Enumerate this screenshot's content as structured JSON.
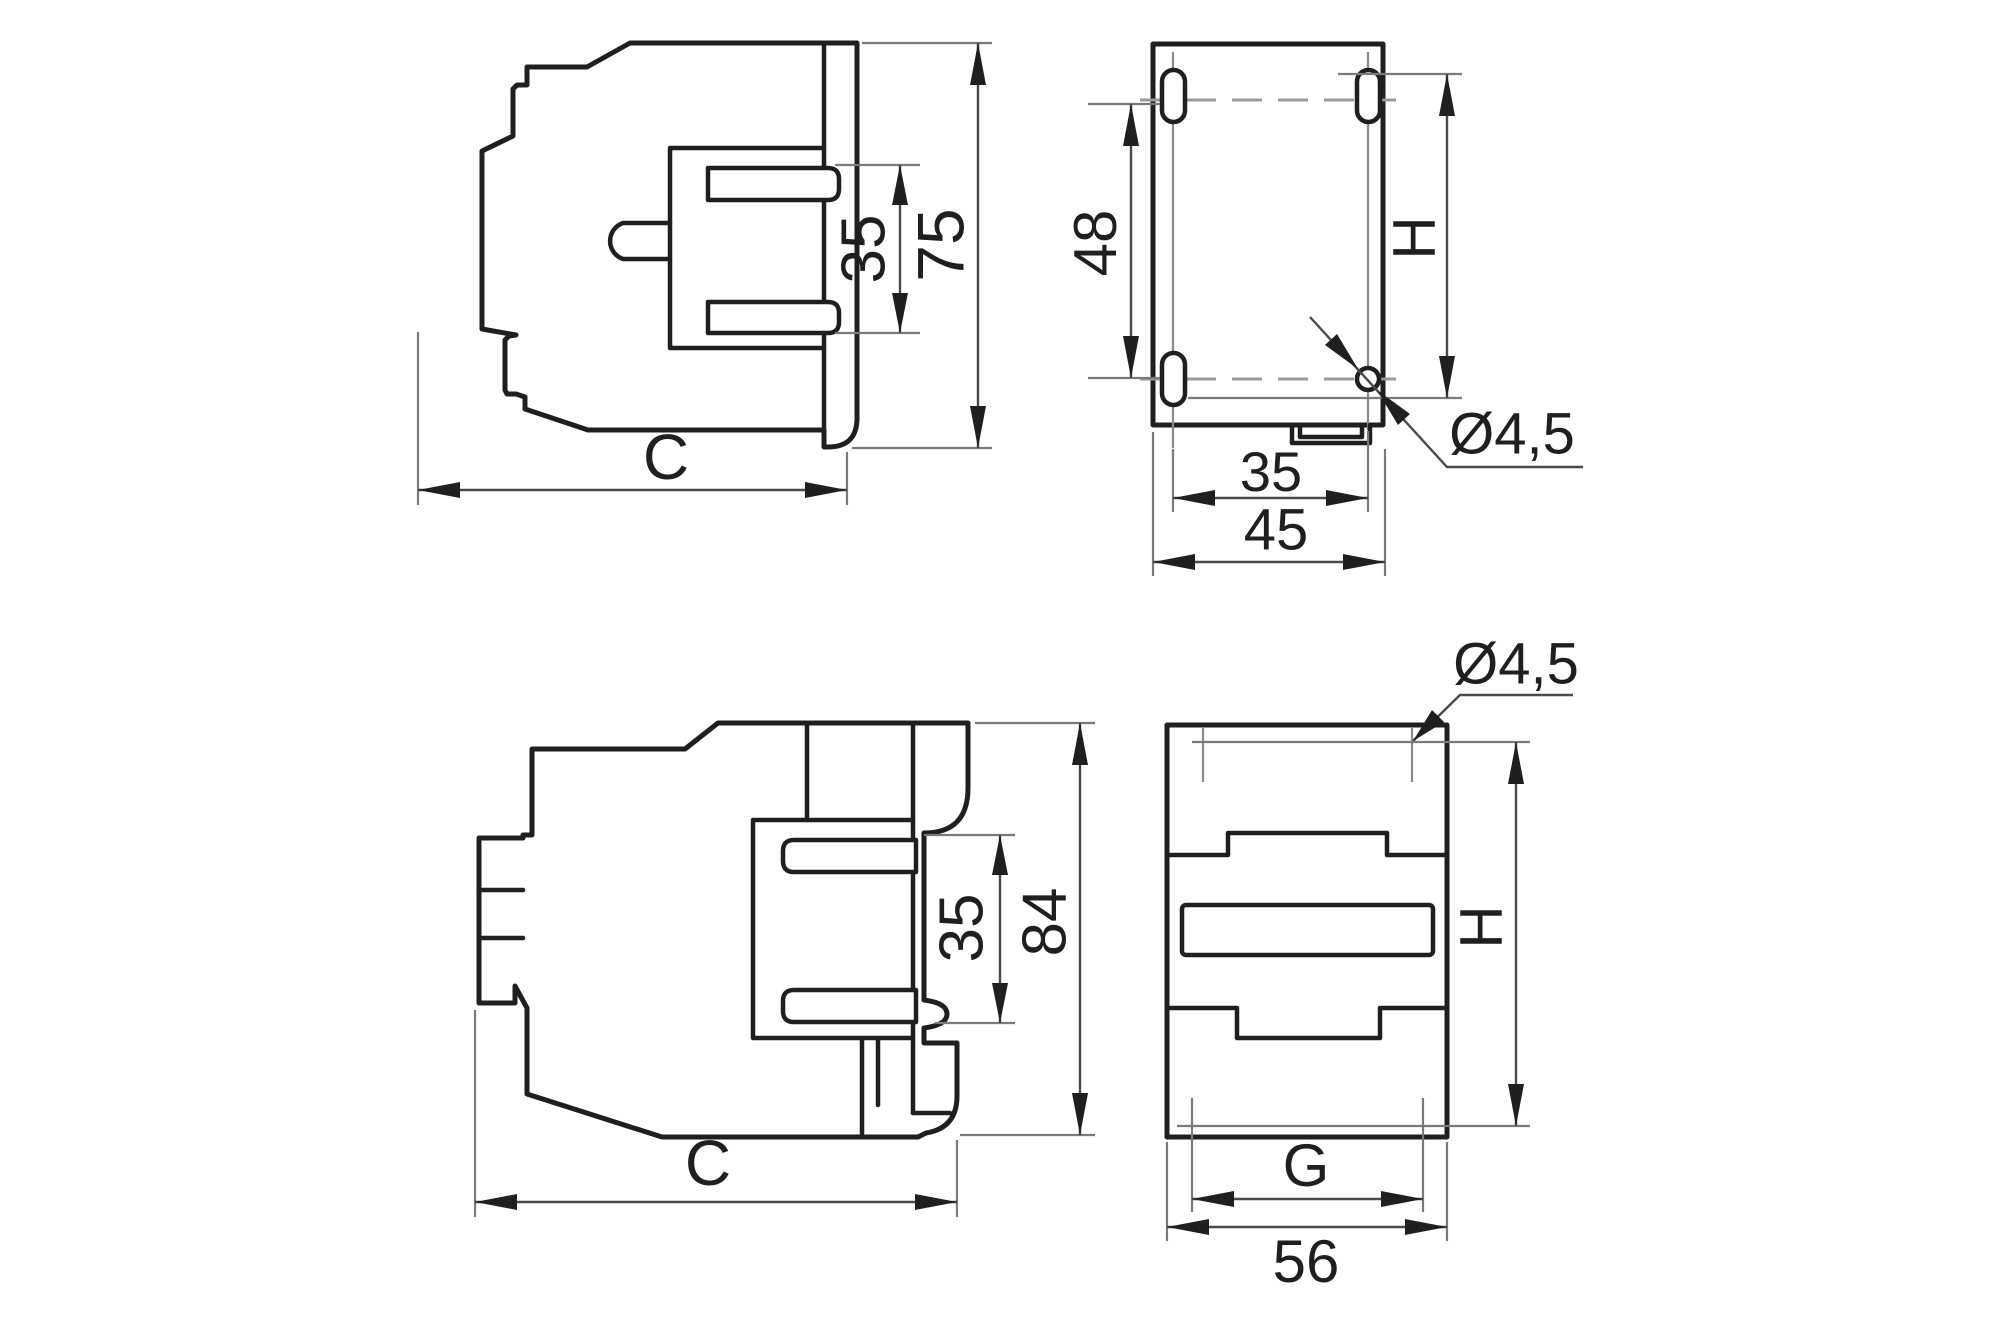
{
  "colors": {
    "background": "#ffffff",
    "outline": "#1f1f1f",
    "dimension_lines": "#4a4a4a",
    "centerlines": "#8a8a8a"
  },
  "views": {
    "top_side": {
      "label_35": "35",
      "label_75": "75",
      "label_c": "C"
    },
    "mounting": {
      "label_48": "48",
      "label_h": "H",
      "label_35": "35",
      "label_45": "45",
      "label_hole": "Ø4,5"
    },
    "bottom_side": {
      "label_35": "35",
      "label_84": "84",
      "label_c": "C"
    },
    "front": {
      "label_hole": "Ø4,5",
      "label_h": "H",
      "label_g": "G",
      "label_56": "56"
    }
  }
}
